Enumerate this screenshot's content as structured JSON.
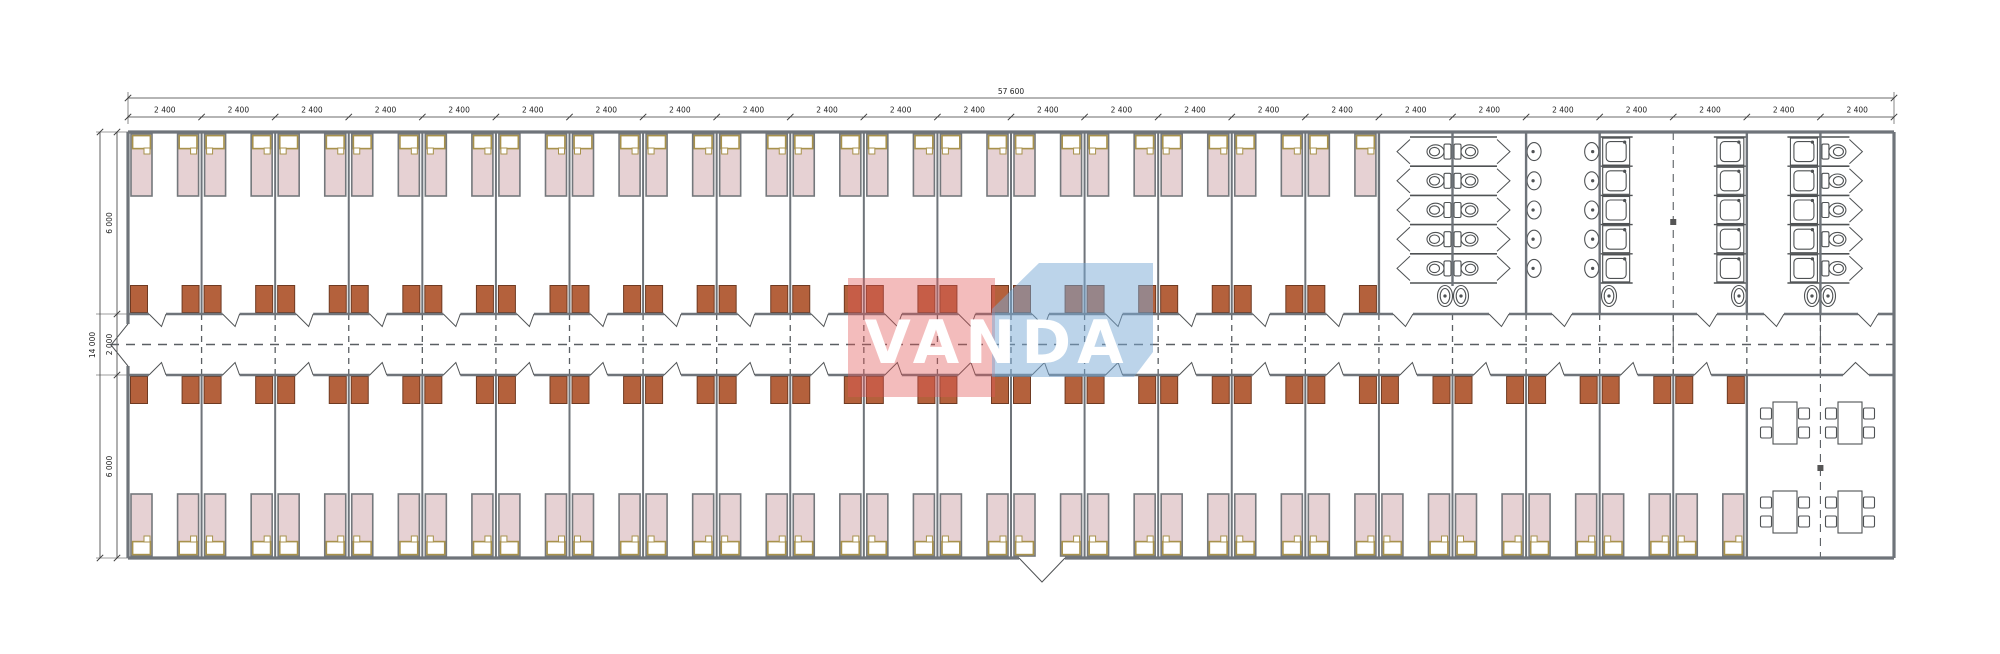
{
  "drawing": {
    "type": "architectural-floor-plan",
    "description": "dormitory container building floor plan with bedrooms, sanitary block and dining room"
  },
  "dimensions": {
    "overall_width_label": "57 600",
    "module_labels": [
      "2 400",
      "2 400",
      "2 400",
      "2 400",
      "2 400",
      "2 400",
      "2 400",
      "2 400",
      "2 400",
      "2 400",
      "2 400",
      "2 400",
      "2 400",
      "2 400",
      "2 400",
      "2 400",
      "2 400",
      "2 400",
      "2 400",
      "2 400",
      "2 400",
      "2 400",
      "2 400",
      "2 400"
    ],
    "overall_height_label": "14 000",
    "height_chain_labels": [
      "6 000",
      "2 000",
      "6 000"
    ]
  },
  "logo": {
    "text": "VANDA",
    "red": "#e25858",
    "blue": "#79a9d6",
    "text_color": "#ffffff"
  },
  "colors": {
    "wall": "#6f747a",
    "wall_light": "#9aa6ad",
    "bed_fill": "#e6d1d3",
    "bed_stroke": "#74787c",
    "pillow_fill": "#ffffff",
    "pillow_stroke": "#a8924c",
    "wardrobe_fill": "#b4613c",
    "wardrobe_stroke": "#6e3a22",
    "fixture_stroke": "#4f5254",
    "dash": "#5a5f63",
    "dim_line": "#3a3a3a",
    "dim_text": "#222222"
  },
  "layout": {
    "modules": 24,
    "top_bedrooms": 17,
    "bottom_bedrooms": 22,
    "beds_top": 34,
    "beds_bottom": 44,
    "wc_stall_rows": 5,
    "wc_right_rows": 5,
    "basin_columns": 2,
    "basin_rows": 5,
    "shower_columns": 3,
    "shower_rows": 5,
    "dining_tables": 4,
    "chairs_per_table": 4
  }
}
